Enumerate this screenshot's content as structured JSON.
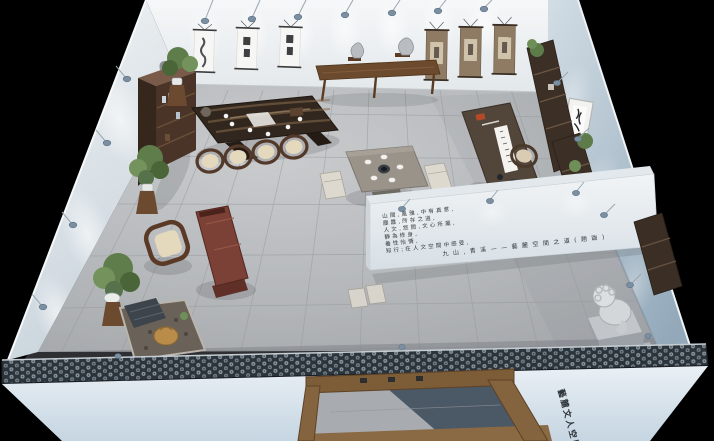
{
  "scene": {
    "kind": "3d-isometric-interior-render",
    "room": "chinese-literati-tea-space"
  },
  "wall_text": {
    "lines": [
      "山間,風雅,中有真意,",
      "塵囂,所存之道,",
      "人文,悠閒,文心所屬,",
      "靜為修身,",
      "養性怡情,",
      "知行;在人文空間中感受,",
      "九山,青溪——藝麓空間之道(題跋)"
    ],
    "color": "#34383c"
  },
  "facade": {
    "sign_text": "藝麓文人空間",
    "sign_color": "#2b3136"
  },
  "palette": {
    "background": "#000000",
    "wall_white": "#eff2f4",
    "wall_blue": "#a9bcca",
    "partition_white": "#e9edf0",
    "floor_gray": "#b3b6b8",
    "roof_dark": "#2c343b",
    "roof_tile_light": "#8d99a2",
    "wood_dark": "#46342a",
    "wood_console": "#6b4a2e",
    "wood_red_bench": "#7b4136",
    "door_frame": "#84643e",
    "bonsai_green": "#5f7d4a",
    "stone_gray": "#c9ccd0",
    "buddha_gold": "#b98c4a",
    "lamp_head": "#7b8fa3",
    "scroll_white": "#f6f6f4",
    "scroll_brown": "#8f7a64"
  }
}
